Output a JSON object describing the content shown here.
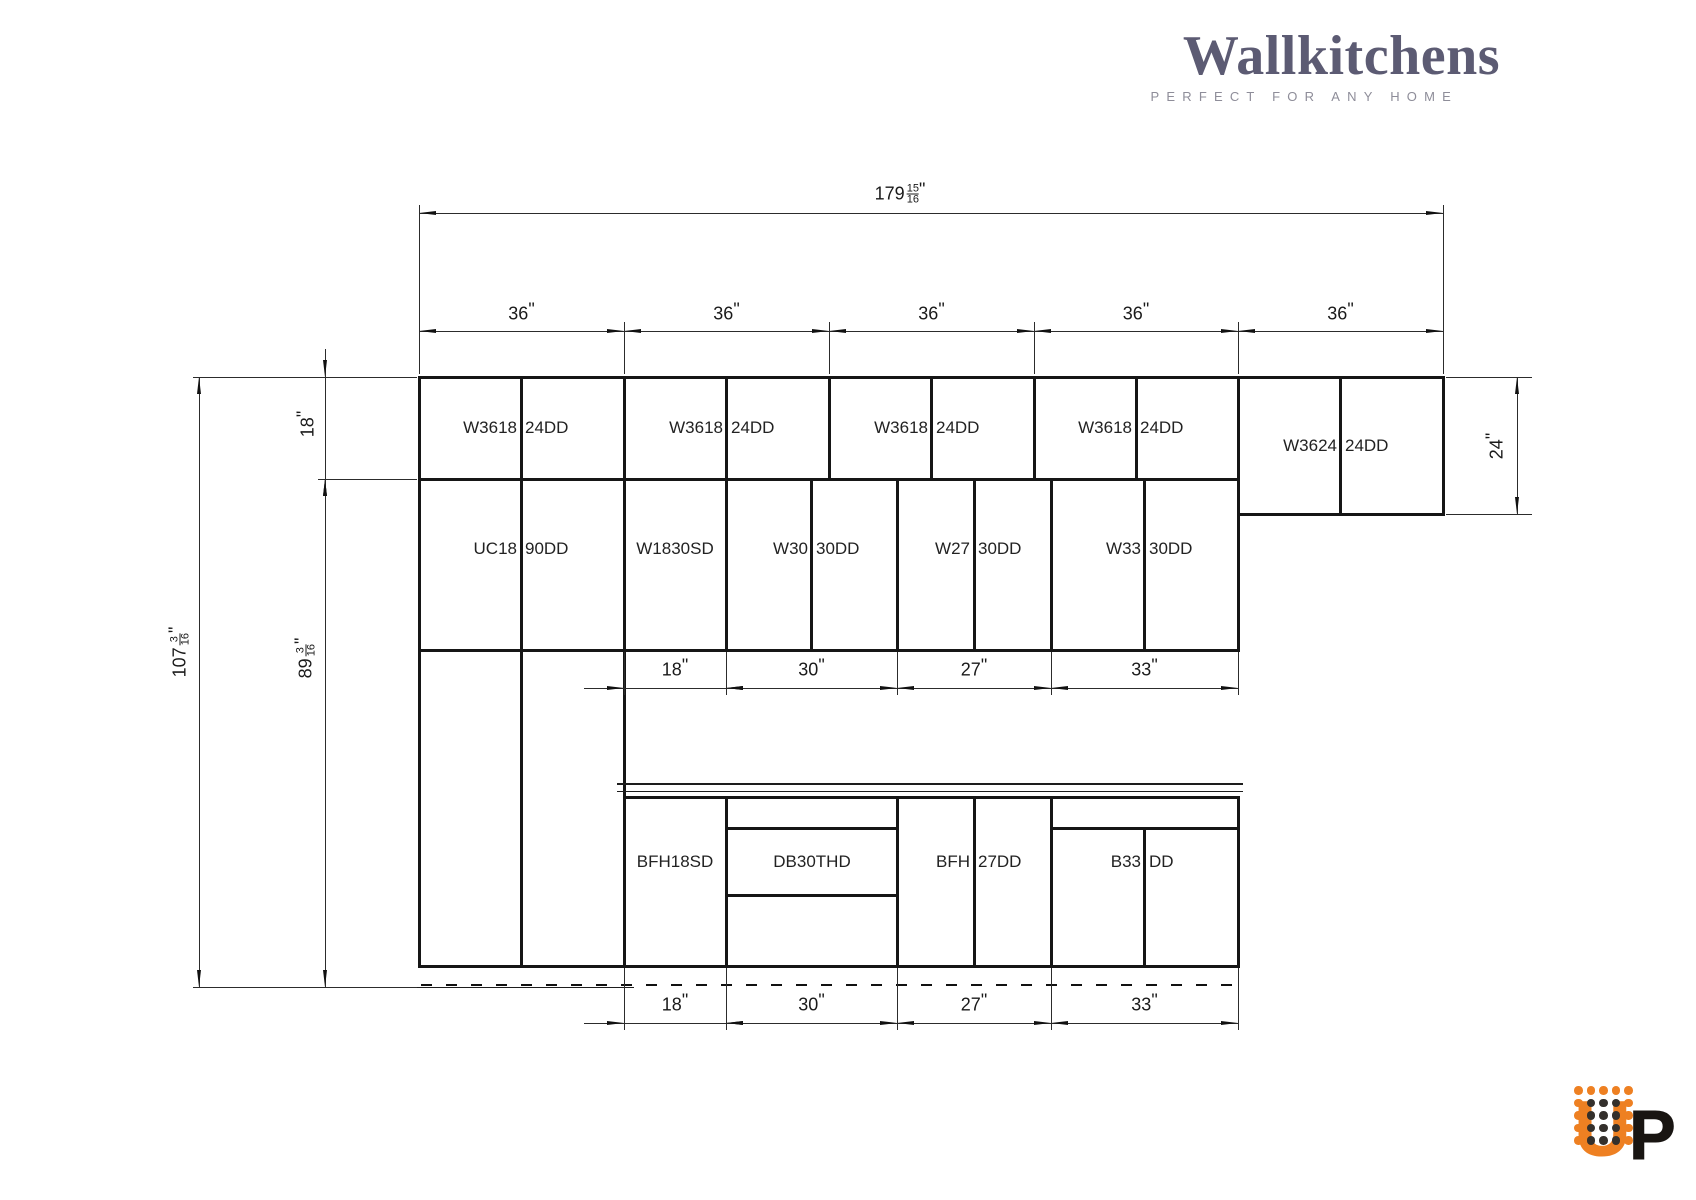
{
  "brand": {
    "name": "Wallkitchens",
    "tagline": "PERFECT FOR ANY HOME",
    "wordmark_color": "#5c5b73",
    "tagline_color": "#8e8d99"
  },
  "up_logo": {
    "u": "U",
    "p": "P",
    "orange": "#ee8022",
    "dark": "#34302c",
    "black": "#191512",
    "dots": [
      [
        "o",
        "o",
        "o",
        "o",
        "o"
      ],
      [
        "o",
        "d",
        "d",
        "d",
        "o"
      ],
      [
        "o",
        "d",
        "d",
        "d",
        "o"
      ],
      [
        "o",
        "d",
        "d",
        "d",
        "o"
      ],
      [
        "o",
        "d",
        "d",
        "d",
        "o"
      ]
    ],
    "dot_origin": {
      "x": 11,
      "y": 30
    },
    "dot_step": 12.5
  },
  "drawing": {
    "unit": "\"",
    "line_color": "#161616",
    "thin_color": "#2c2c2c",
    "boxes": [
      {
        "x": 419,
        "y": 377,
        "w": 205,
        "h": 589,
        "div": true,
        "hl": [
          102,
          273
        ]
      },
      {
        "x": 624,
        "y": 377,
        "w": 205,
        "h": 102,
        "div": true
      },
      {
        "x": 829,
        "y": 377,
        "w": 205,
        "h": 102,
        "div": true
      },
      {
        "x": 1034,
        "y": 377,
        "w": 204,
        "h": 102,
        "div": true
      },
      {
        "x": 1238,
        "y": 377,
        "w": 205,
        "h": 137,
        "div": true
      },
      {
        "x": 624,
        "y": 479,
        "w": 102,
        "h": 171
      },
      {
        "x": 726,
        "y": 479,
        "w": 171,
        "h": 171,
        "div": true
      },
      {
        "x": 897,
        "y": 479,
        "w": 154,
        "h": 171,
        "div": true
      },
      {
        "x": 1051,
        "y": 479,
        "w": 187,
        "h": 171,
        "div": true
      },
      {
        "x": 624,
        "y": 797,
        "w": 102,
        "h": 169
      },
      {
        "x": 726,
        "y": 797,
        "w": 171,
        "h": 169,
        "hl": [
          31,
          98
        ]
      },
      {
        "x": 897,
        "y": 797,
        "w": 154,
        "h": 169,
        "div": true
      },
      {
        "x": 1051,
        "y": 797,
        "w": 187,
        "h": 169,
        "div": true,
        "div_top": 31,
        "hl": [
          31
        ]
      }
    ],
    "labels": [
      {
        "parts": [
          "W3618",
          "24DD"
        ],
        "cx": 521,
        "cy": 428
      },
      {
        "parts": [
          "W3618",
          "24DD"
        ],
        "cx": 727,
        "cy": 428
      },
      {
        "parts": [
          "W3618",
          "24DD"
        ],
        "cx": 932,
        "cy": 428
      },
      {
        "parts": [
          "W3618",
          "24DD"
        ],
        "cx": 1136,
        "cy": 428
      },
      {
        "parts": [
          "W3624",
          "24DD"
        ],
        "cx": 1341,
        "cy": 446
      },
      {
        "parts": [
          "UC18",
          "90DD"
        ],
        "cx": 521,
        "cy": 549
      },
      {
        "parts": [
          "W1830SD"
        ],
        "cx": 675,
        "cy": 549
      },
      {
        "parts": [
          "W30",
          "30DD"
        ],
        "cx": 812,
        "cy": 549
      },
      {
        "parts": [
          "W27",
          "30DD"
        ],
        "cx": 974,
        "cy": 549
      },
      {
        "parts": [
          "W33",
          "30DD"
        ],
        "cx": 1145,
        "cy": 549
      },
      {
        "parts": [
          "BFH18SD"
        ],
        "cx": 675,
        "cy": 862
      },
      {
        "parts": [
          "DB30THD"
        ],
        "cx": 812,
        "cy": 862
      },
      {
        "parts": [
          "BFH",
          "27DD"
        ],
        "cx": 974,
        "cy": 862
      },
      {
        "parts": [
          "B33",
          "DD"
        ],
        "cx": 1145,
        "cy": 862
      }
    ],
    "h_dims": [
      {
        "y": 213,
        "text_cy": 194,
        "bounds": [
          419,
          1443
        ],
        "segs": [
          {
            "label": {
              "w": "179",
              "n": "15",
              "d": "16"
            },
            "arrows": "in",
            "text_cx": 900
          }
        ],
        "exts": {
          "xs": [
            419,
            1443
          ],
          "y1": 205,
          "y2": 374
        }
      },
      {
        "y": 331,
        "text_cy": 314,
        "bounds": [
          419,
          624,
          829,
          1034,
          1238,
          1443
        ],
        "segs": [
          {
            "label": {
              "w": "36"
            },
            "arrows": "in"
          },
          {
            "label": {
              "w": "36"
            },
            "arrows": "in"
          },
          {
            "label": {
              "w": "36"
            },
            "arrows": "in"
          },
          {
            "label": {
              "w": "36"
            },
            "arrows": "in"
          },
          {
            "label": {
              "w": "36"
            },
            "arrows": "in"
          }
        ],
        "exts": {
          "xs": [
            624,
            829,
            1034,
            1238
          ],
          "y1": 322,
          "y2": 374
        }
      },
      {
        "y": 688,
        "text_cy": 670,
        "lead_left": 40,
        "bounds": [
          624,
          726,
          897,
          1051,
          1238
        ],
        "segs": [
          {
            "label": {
              "w": "18"
            },
            "arrows": "out"
          },
          {
            "label": {
              "w": "30"
            },
            "arrows": "in"
          },
          {
            "label": {
              "w": "27"
            },
            "arrows": "in"
          },
          {
            "label": {
              "w": "33"
            },
            "arrows": "in"
          }
        ],
        "exts": {
          "xs": [
            624,
            726,
            897,
            1051,
            1238
          ],
          "y1": 652,
          "y2": 695
        }
      },
      {
        "y": 1023,
        "text_cy": 1005,
        "lead_left": 40,
        "bounds": [
          624,
          726,
          897,
          1051,
          1238
        ],
        "segs": [
          {
            "label": {
              "w": "18"
            },
            "arrows": "out"
          },
          {
            "label": {
              "w": "30"
            },
            "arrows": "in"
          },
          {
            "label": {
              "w": "27"
            },
            "arrows": "in"
          },
          {
            "label": {
              "w": "33"
            },
            "arrows": "in"
          }
        ],
        "exts": {
          "xs": [
            624,
            726,
            897,
            1051,
            1238
          ],
          "y1": 968,
          "y2": 1030
        }
      }
    ],
    "v_dims": [
      {
        "x": 199,
        "y1": 377,
        "y2": 987,
        "arrows": "in",
        "label": {
          "w": "107",
          "n": "3",
          "d": "16"
        },
        "text_cx": 180,
        "text_cy": 652,
        "exts": [
          {
            "y": 377,
            "x1": 193,
            "x2": 417
          },
          {
            "y": 987,
            "x1": 193,
            "x2": 417
          }
        ]
      },
      {
        "x": 325,
        "y1": 479,
        "y2": 987,
        "arrows": "in",
        "label": {
          "w": "89",
          "n": "3",
          "d": "16"
        },
        "text_cx": 306,
        "text_cy": 658,
        "exts": [
          {
            "y": 479,
            "x1": 318,
            "x2": 417
          }
        ]
      },
      {
        "x": 325,
        "y1": 377,
        "y2": 479,
        "arrows": "out",
        "label": {
          "w": "18"
        },
        "text_cx": 308,
        "text_cy": 424,
        "tails": [
          {
            "y1": 349,
            "y2": 377
          },
          {
            "y1": 479,
            "y2": 511
          }
        ]
      },
      {
        "x": 1517,
        "y1": 377,
        "y2": 514,
        "arrows": "in",
        "label": {
          "w": "24"
        },
        "text_cx": 1497,
        "text_cy": 446,
        "exts": [
          {
            "y": 377,
            "x1": 1446,
            "x2": 1532
          },
          {
            "y": 514,
            "x1": 1446,
            "x2": 1532
          }
        ]
      }
    ],
    "misc": [
      {
        "type": "h",
        "y": 784,
        "x1": 617,
        "x2": 1243,
        "th": 2,
        "name": "countertop-line"
      },
      {
        "type": "h",
        "y": 791,
        "x1": 617,
        "x2": 1243,
        "th": 1,
        "name": "countertop-line"
      },
      {
        "type": "h",
        "y": 987,
        "x1": 199,
        "x2": 634,
        "th": 1,
        "name": "floor-line"
      },
      {
        "type": "dash",
        "y": 985,
        "x1": 421,
        "x2": 1238,
        "name": "toe-kick-dashed-line"
      }
    ]
  }
}
